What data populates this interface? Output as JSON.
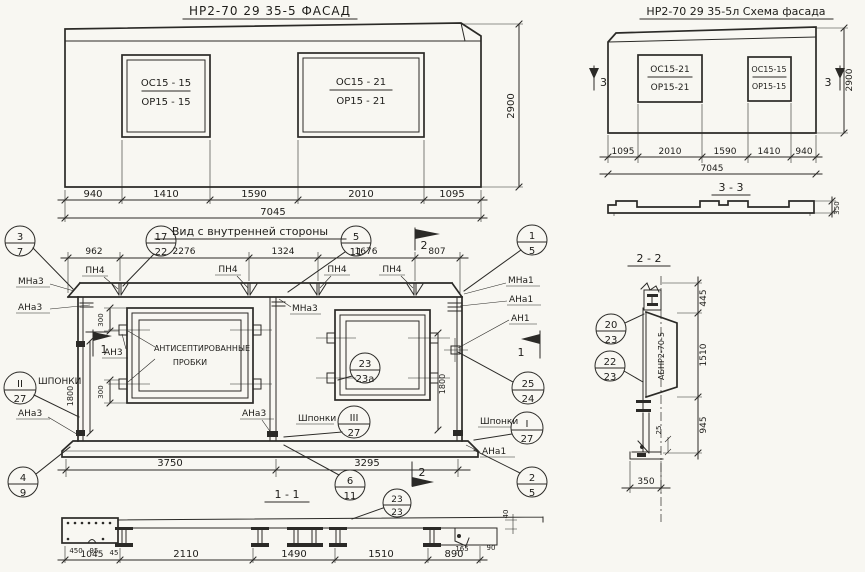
{
  "facade": {
    "title": "НР2-70 29  35-5    ФАСАД",
    "window_left": {
      "top": "ОС15 - 15",
      "bottom": "ОР15 - 15"
    },
    "window_right": {
      "top": "ОС15 - 21",
      "bottom": "ОР15 - 21"
    },
    "dims": [
      "940",
      "1410",
      "1590",
      "2010",
      "1095"
    ],
    "total": "7045",
    "height": "2900"
  },
  "schema": {
    "title": "НР2-70 29 35-5л   Схема фасада",
    "window_left": {
      "top": "ОС15-21",
      "bottom": "ОР15-21"
    },
    "window_right": {
      "top": "ОС15-15",
      "bottom": "ОР15-15"
    },
    "dims": [
      "1095",
      "2010",
      "1590",
      "1410",
      "940"
    ],
    "total": "7045",
    "height": "2900",
    "marker": "3"
  },
  "section33": {
    "title": "3 - 3",
    "depth": "350"
  },
  "inner": {
    "title": "Вид с внутренней стороны",
    "dims_top": [
      "962",
      "2276",
      "1324",
      "1676",
      "807"
    ],
    "dims_bottom": [
      "3750",
      "3295"
    ],
    "dim_vert": "1800",
    "dim_300": "300",
    "labels": {
      "pn4": "ПН4",
      "mna3": "МНа3",
      "ana3": "АНа3",
      "an3": "АН3",
      "mna1": "МНа1",
      "ana1": "АНа1",
      "an1": "АН1",
      "shponki": "Шпонки",
      "shponki_caps": "ШПОНКИ"
    },
    "note": {
      "line1": "АНТИСЕПТИРОВАННЫЕ",
      "line2": "ПРОБКИ"
    },
    "callouts": {
      "c3_7": {
        "t": "3",
        "b": "7"
      },
      "c17_22": {
        "t": "17",
        "b": "22"
      },
      "c5_11": {
        "t": "5",
        "b": "11"
      },
      "c1_5": {
        "t": "1",
        "b": "5"
      },
      "c4_9": {
        "t": "4",
        "b": "9"
      },
      "c6_11": {
        "t": "6",
        "b": "11"
      },
      "c2_5": {
        "t": "2",
        "b": "5"
      },
      "c23_23a": {
        "t": "23",
        "b": "23а"
      },
      "c25_24": {
        "t": "25",
        "b": "24"
      },
      "cII_27": {
        "t": "II",
        "b": "27"
      },
      "cIII_27": {
        "t": "III",
        "b": "27"
      },
      "cI_27": {
        "t": "I",
        "b": "27"
      }
    },
    "markers": {
      "m1": "1",
      "m2": "2"
    }
  },
  "section11": {
    "title": "1 - 1",
    "dims": [
      "1045",
      "2110",
      "1490",
      "1510",
      "890"
    ],
    "small_dims": [
      "450",
      "95",
      "45",
      "165",
      "90",
      "40"
    ],
    "callout": {
      "t": "23",
      "b": "23"
    }
  },
  "section22": {
    "title": "2 - 2",
    "dims": {
      "top": "445",
      "mid": "1510",
      "bottom": "945",
      "small": "25",
      "width": "350"
    },
    "stamp": "АБНР2-70-5",
    "callouts": {
      "c20_23": {
        "t": "20",
        "b": "23"
      },
      "c22_23": {
        "t": "22",
        "b": "23"
      }
    }
  }
}
